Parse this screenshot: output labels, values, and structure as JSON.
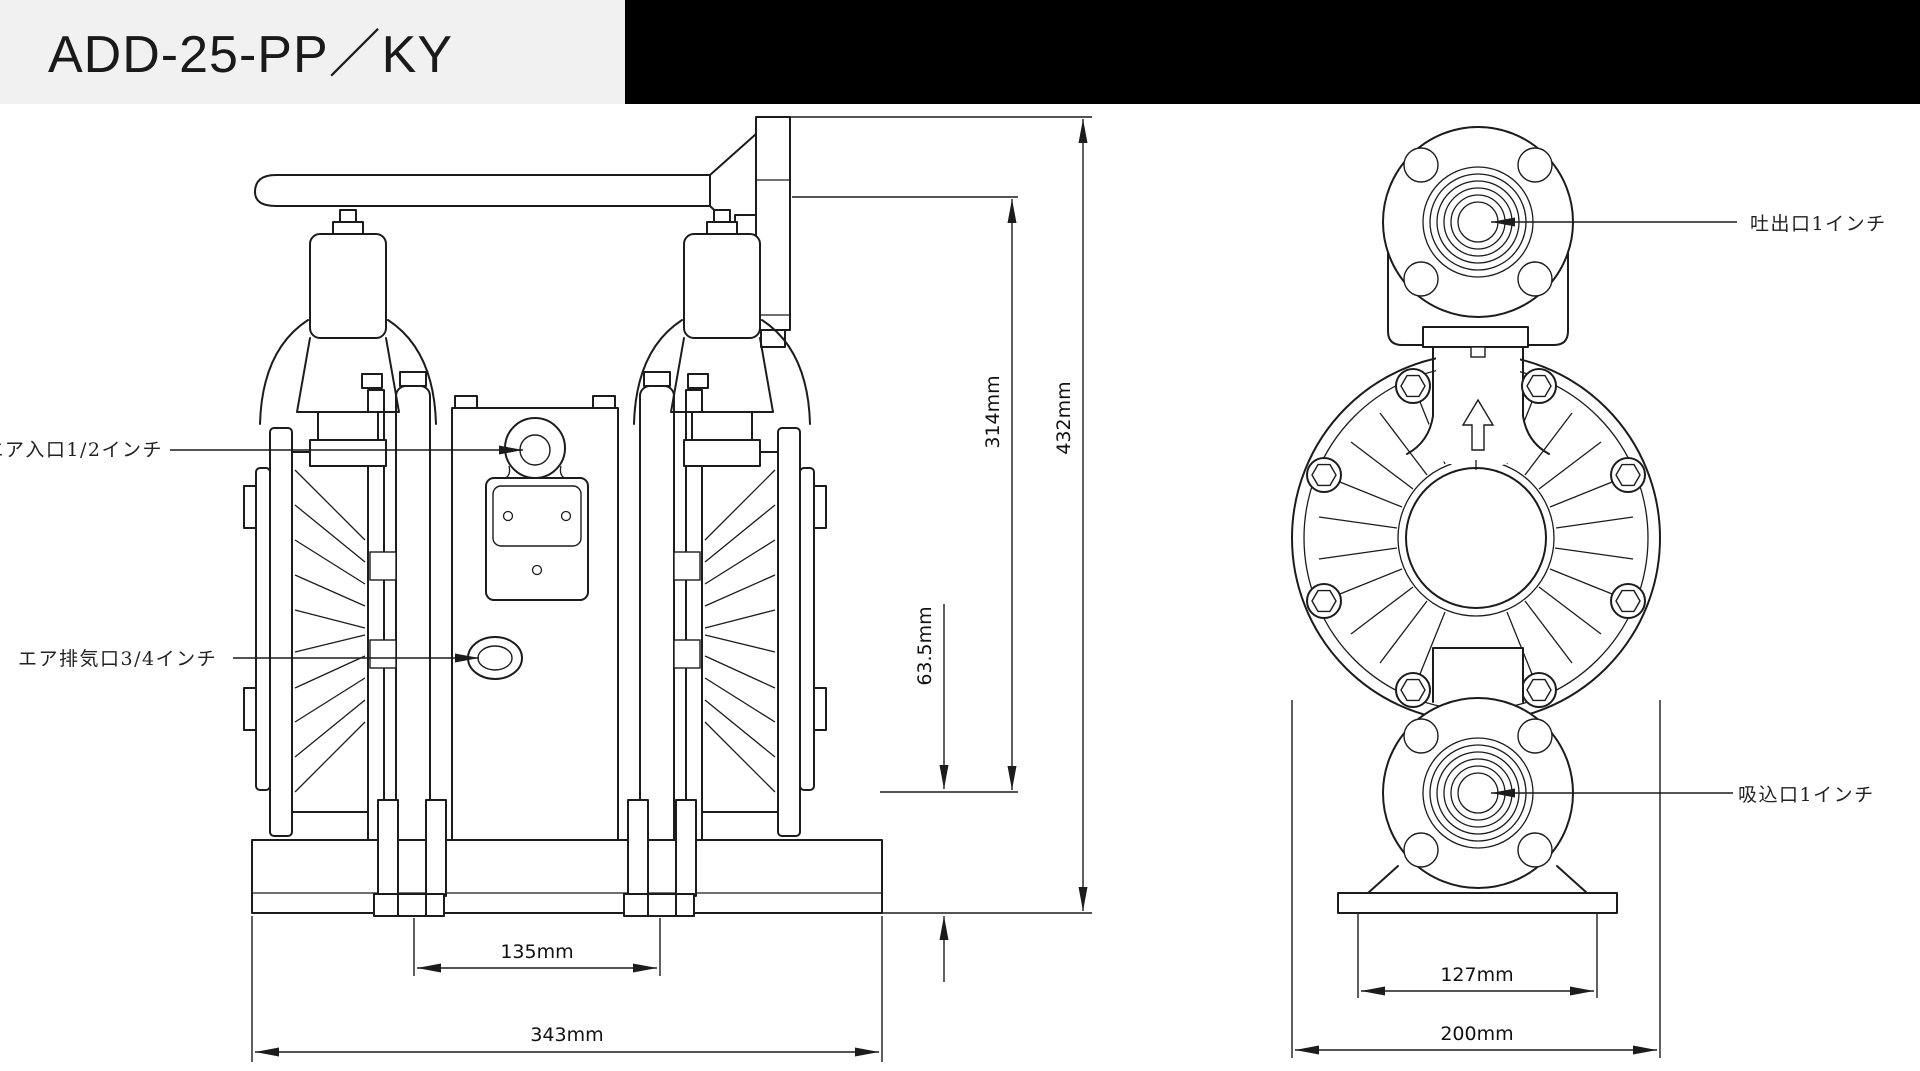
{
  "header": {
    "title": "ADD-25-PP／KY"
  },
  "front_view": {
    "labels": {
      "air_inlet": "動力エア入口1/2インチ",
      "air_exhaust": "エア排気口3/4インチ"
    },
    "dims": {
      "overall_height": "432mm",
      "discharge_height": "314mm",
      "base_height": "63.5mm",
      "foot_pitch": "135mm",
      "overall_width": "343mm"
    }
  },
  "side_view": {
    "labels": {
      "discharge": "吐出口1インチ",
      "suction": "吸込口1インチ"
    },
    "dims": {
      "base_width": "127mm",
      "overall_width": "200mm"
    }
  },
  "colors": {
    "line": "#1c1c1c",
    "title_bg": "#f1f1f1",
    "header_bar": "#000000",
    "background": "#ffffff"
  }
}
